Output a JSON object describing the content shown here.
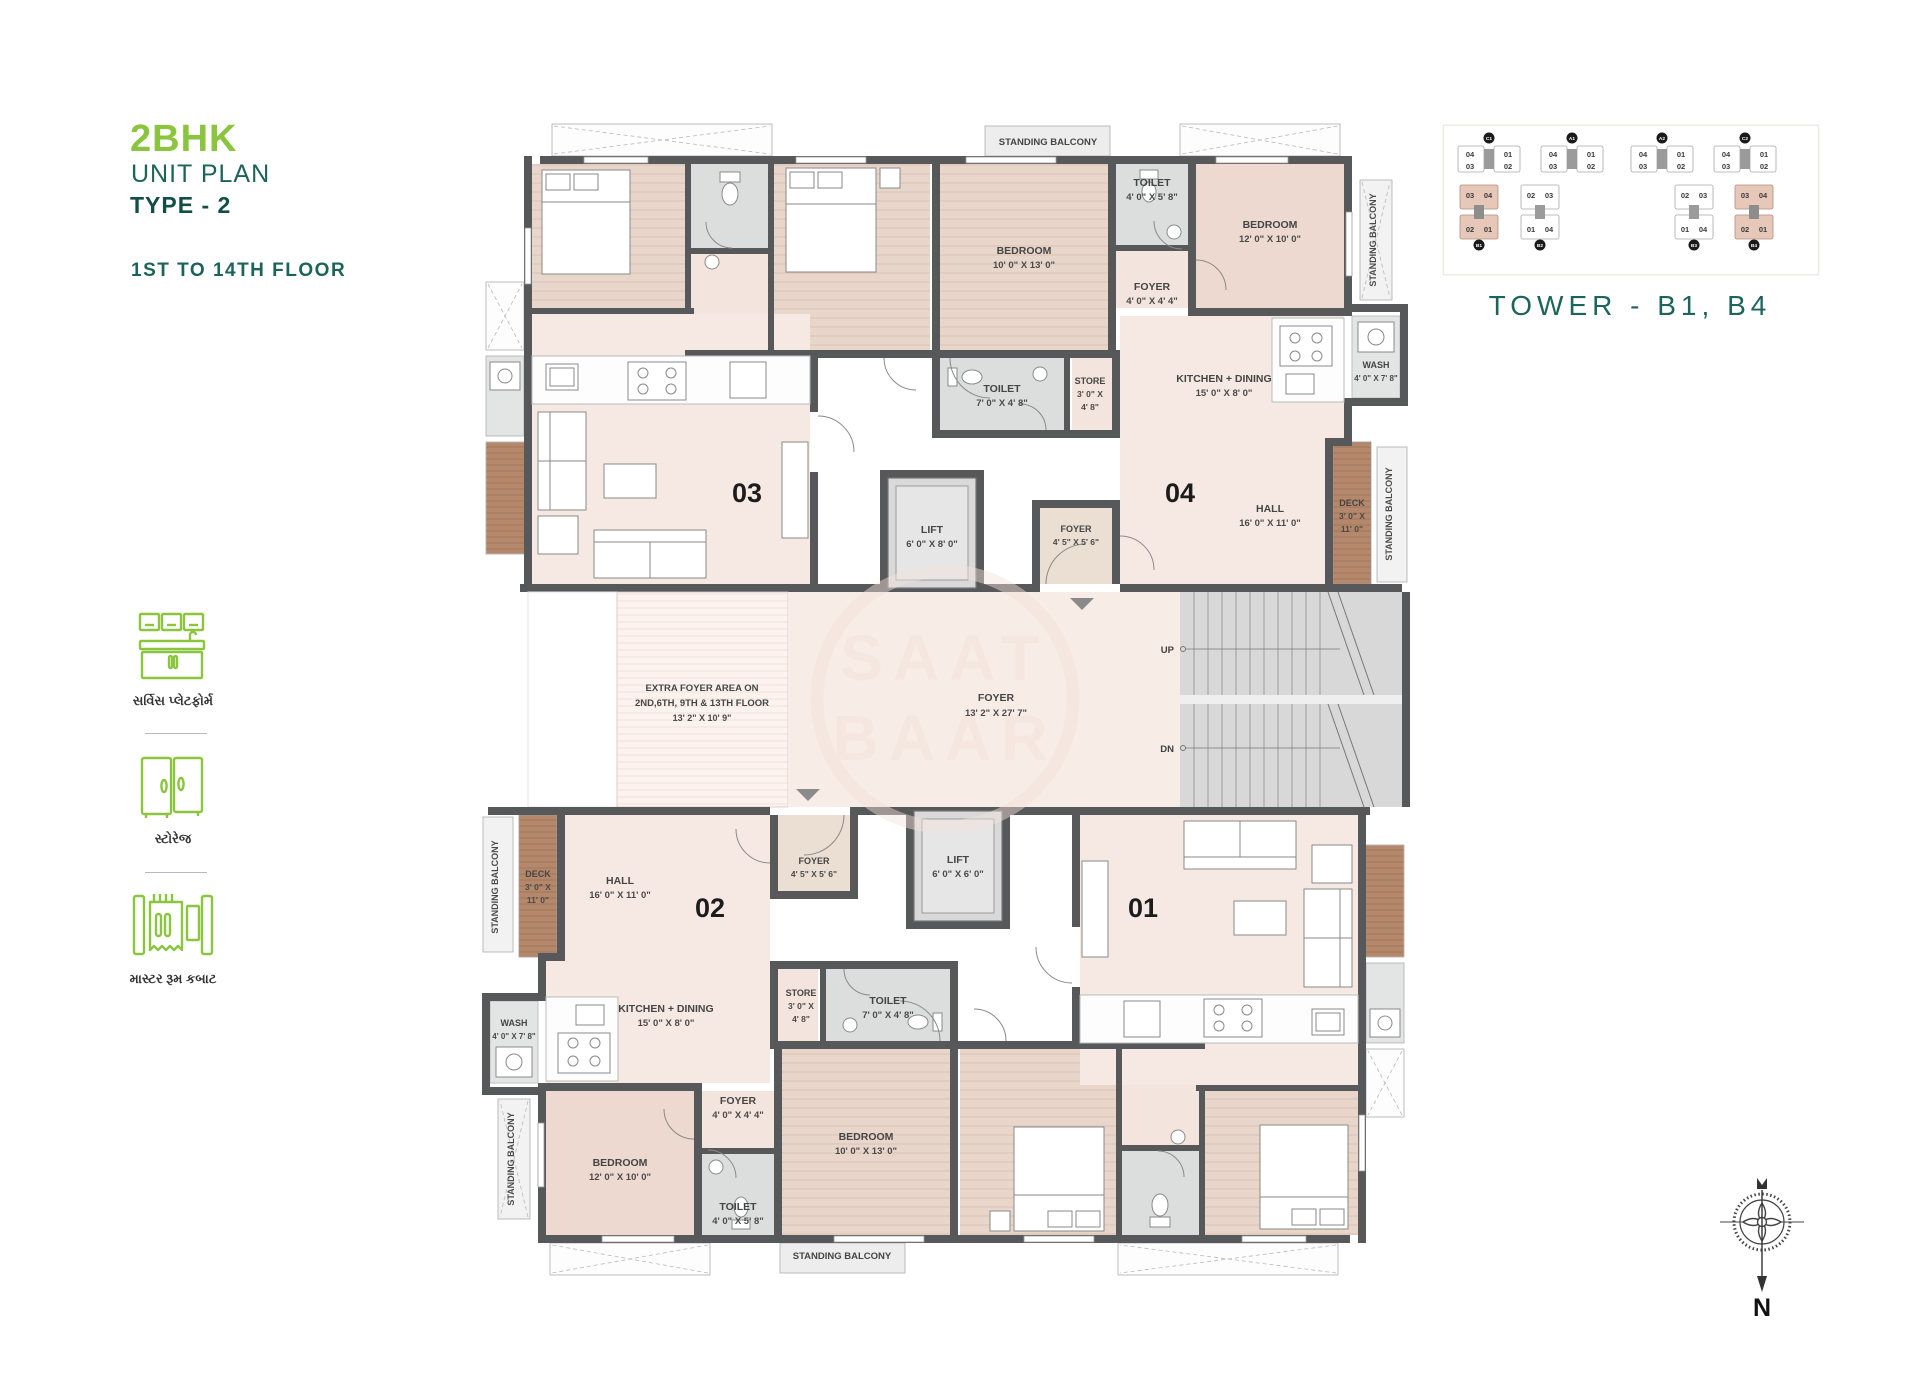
{
  "colors": {
    "accent_green": "#8bc53f",
    "accent_teal": "#1c645a",
    "teal_dark": "#124e46",
    "wall": "#57585a",
    "room_pink": "#f6e9e3",
    "bedroom_wood": "#e9d6cb",
    "bedroom_plain": "#edd9d0",
    "toilet_gray": "#dcdddd",
    "deck_brown": "#b5886b",
    "foyer_beige": "#eadfd2",
    "keyplan_highlight": "#e6c7b8"
  },
  "header": {
    "bhk": "2BHK",
    "unit_plan": "UNIT PLAN",
    "plan_type": "TYPE - 2",
    "floors": "1ST TO 14TH FLOOR"
  },
  "legend": {
    "items": [
      {
        "icon": "service-platform-icon",
        "label": "સર્વિસ પ્લેટફોર્મ"
      },
      {
        "icon": "storage-icon",
        "label": "સ્ટોરેજ"
      },
      {
        "icon": "master-cupboard-icon",
        "label": "માસ્ટર રૂમ કબાટ"
      }
    ]
  },
  "keyplan": {
    "caption": "TOWER - B1, B4",
    "row1": [
      {
        "id": "C1",
        "units": [
          "04",
          "01",
          "03",
          "02"
        ],
        "highlighted": false
      },
      {
        "id": "A1",
        "units": [
          "04",
          "01",
          "03",
          "02"
        ],
        "highlighted": false
      },
      {
        "id": "A2",
        "units": [
          "04",
          "01",
          "03",
          "02"
        ],
        "highlighted": false
      },
      {
        "id": "C2",
        "units": [
          "04",
          "01",
          "03",
          "02"
        ],
        "highlighted": false
      }
    ],
    "row2": [
      {
        "id": "B1",
        "units": [
          "03",
          "04",
          "02",
          "01"
        ],
        "highlighted": true
      },
      {
        "id": "B2",
        "units": [
          "02",
          "03",
          "01",
          "04"
        ],
        "highlighted": false
      },
      {
        "id": "B3",
        "units": [
          "02",
          "03",
          "01",
          "04"
        ],
        "highlighted": false
      },
      {
        "id": "B4",
        "units": [
          "03",
          "04",
          "02",
          "01"
        ],
        "highlighted": true
      }
    ]
  },
  "plan": {
    "units": {
      "u01": "01",
      "u02": "02",
      "u03": "03",
      "u04": "04"
    },
    "rooms": {
      "standing_balcony": "STANDING BALCONY",
      "bedroom_10x13": {
        "name": "BEDROOM",
        "dims": "10' 0\" X 13' 0\""
      },
      "bedroom_12x10": {
        "name": "BEDROOM",
        "dims": "12' 0\" X 10' 0\""
      },
      "toilet_4x5": {
        "name": "TOILET",
        "dims": "4' 0\" X 5' 8\""
      },
      "toilet_7x4": {
        "name": "TOILET",
        "dims": "7' 0\" X 4' 8\""
      },
      "foyer_4x4": {
        "name": "FOYER",
        "dims": "4' 0\" X 4' 4\""
      },
      "foyer_4_5": {
        "name": "FOYER",
        "dims": "4' 5\" X 5' 6\""
      },
      "kitchen_dining": {
        "name": "KITCHEN + DINING",
        "dims": "15' 0\" X 8' 0\""
      },
      "wash": {
        "name": "WASH",
        "dims": "4' 0\" X 7' 8\""
      },
      "store": {
        "name": "STORE",
        "dims1": "3' 0\" X",
        "dims2": "4' 8\""
      },
      "hall": {
        "name": "HALL",
        "dims": "16' 0\" X 11' 0\""
      },
      "deck": {
        "name": "DECK",
        "dims1": "3' 0\" X",
        "dims2": "11' 0\""
      },
      "lift_top": {
        "name": "LIFT",
        "dims": "6' 0\" X 8' 0\""
      },
      "lift_bottom": {
        "name": "LIFT",
        "dims": "6' 0\" X 6' 0\""
      },
      "foyer_central": {
        "name": "FOYER",
        "dims": "13' 2\" X 27' 7\""
      },
      "extra_foyer": {
        "line1": "EXTRA FOYER AREA ON",
        "line2": "2ND,6TH, 9TH & 13TH FLOOR",
        "line3": "13' 2\" X 10' 9\""
      },
      "up": "UP",
      "dn": "DN"
    },
    "watermark": {
      "line1": "SAAT",
      "line2": "BAAR"
    },
    "compass": "N"
  }
}
